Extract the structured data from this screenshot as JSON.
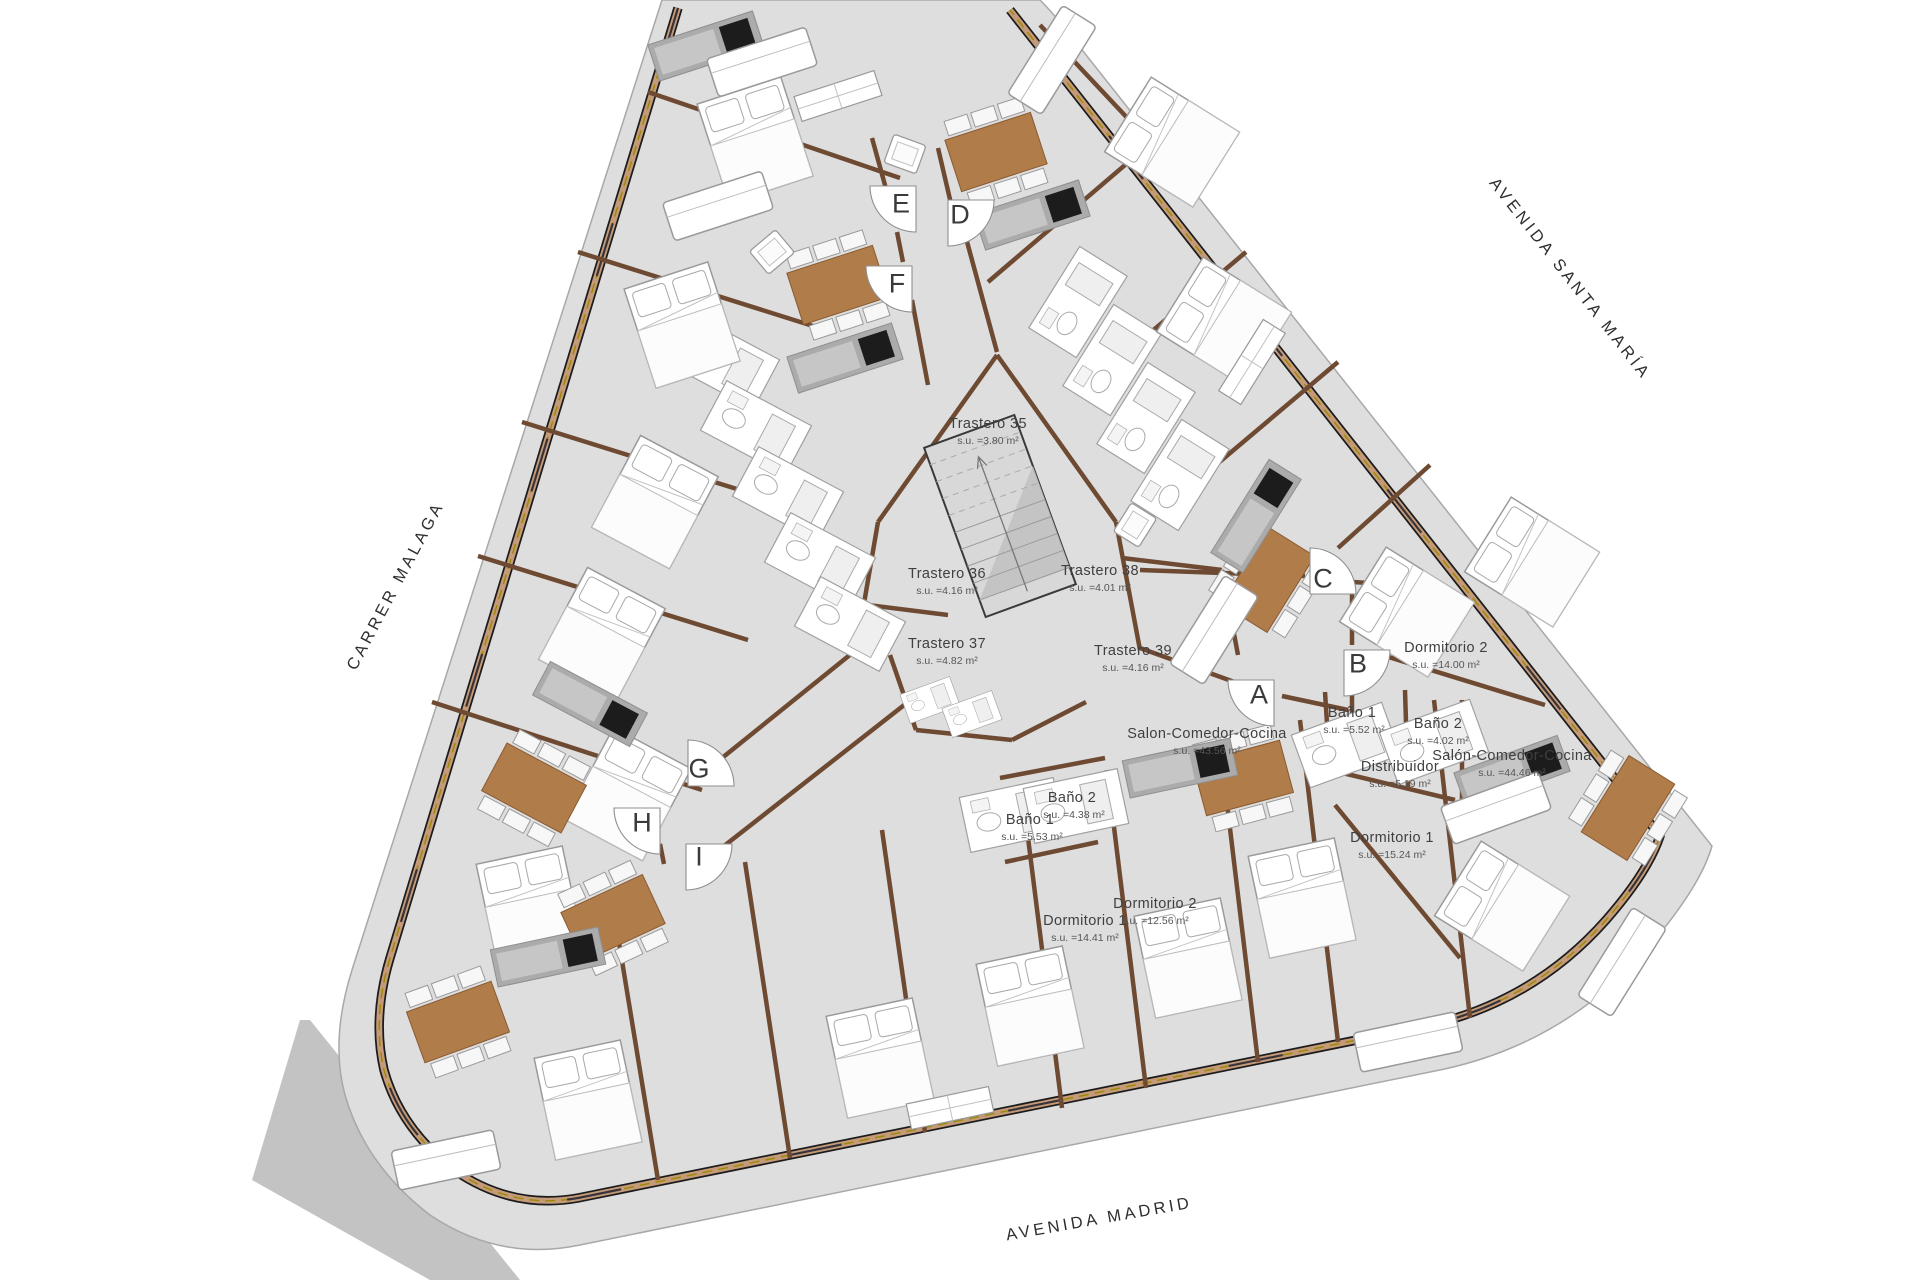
{
  "plan": {
    "streets": {
      "carrer_malaga": "CARRER MALAGA",
      "avenida_santa_maria": "AVENIDA SANTA MARÍA",
      "avenida_madrid": "AVENIDA MADRID"
    },
    "entrances": {
      "a": "A",
      "b": "B",
      "c": "C",
      "d": "D",
      "e": "E",
      "f": "F",
      "g": "G",
      "h": "H",
      "i": "I"
    },
    "rooms": {
      "trastero35": {
        "label": "Trastero 35",
        "area": "s.u. =3.80 m²"
      },
      "trastero36": {
        "label": "Trastero 36",
        "area": "s.u. =4.16 m²"
      },
      "trastero37": {
        "label": "Trastero 37",
        "area": "s.u. =4.82 m²"
      },
      "trastero38": {
        "label": "Trastero 38",
        "area": "s.u. =4.01 m²"
      },
      "trastero39": {
        "label": "Trastero 39",
        "area": "s.u. =4.16 m²"
      },
      "salon_comedor_cocina_a": {
        "label": "Salon-Comedor-Cocina",
        "area": "s.u. =43.56 m²"
      },
      "bano1_a": {
        "label": "Baño 1",
        "area": "s.u. =5.53 m²"
      },
      "bano2_a": {
        "label": "Baño 2",
        "area": "s.u. =4.38 m²"
      },
      "dormitorio1_a": {
        "label": "Dormitorio 1",
        "area": "s.u. =14.41 m²"
      },
      "dormitorio2_a": {
        "label": "Dormitorio 2",
        "area": "s.u. =12.56 m²"
      },
      "bano1_b": {
        "label": "Baño 1",
        "area": "s.u. =5.52 m²"
      },
      "bano2_b": {
        "label": "Baño 2",
        "area": "s.u. =4.02 m²"
      },
      "distribuidor": {
        "label": "Distribuidor",
        "area": "s.u. =5.19 m²"
      },
      "salon_comedor_cocina_b": {
        "label": "Salón-Comedor-Cocina",
        "area": "s.u. =44.46 m²"
      },
      "dormitorio1_b": {
        "label": "Dormitorio 1",
        "area": "s.u. =15.24 m²"
      },
      "dormitorio2_b": {
        "label": "Dormitorio 2",
        "area": "s.u. =14.00 m²"
      }
    },
    "colors": {
      "floor": "#dedede",
      "ground": "#c3c3c3",
      "wall_exterior": "#c49a78",
      "wall_interior": "#6e4a33",
      "insulation": "#9a8a00",
      "table": "#b07c4a",
      "counter": "#ababab",
      "cooktop": "#1c1c1c"
    }
  }
}
